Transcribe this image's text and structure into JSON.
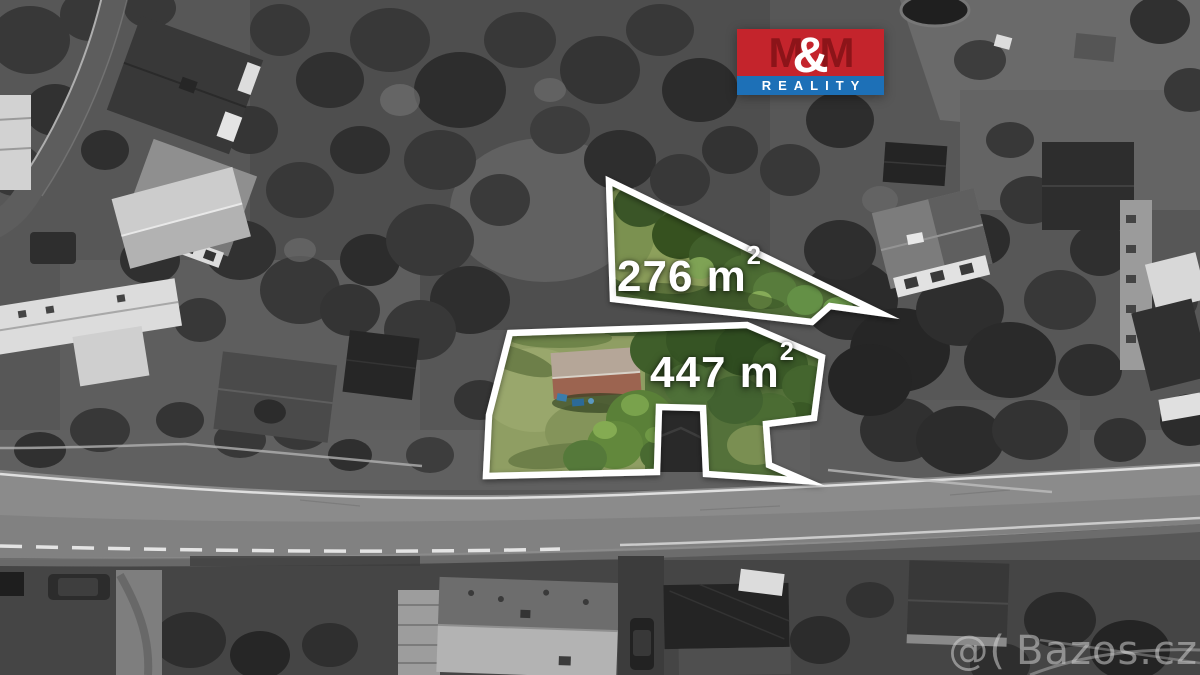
{
  "logo": {
    "m_left": "M",
    "ampersand": "&",
    "m_right": "M",
    "subtitle": "REALITY"
  },
  "plots": [
    {
      "name": "plot-276",
      "area_value": "276 m",
      "area_superscript": "2",
      "full_label": "276 m²"
    },
    {
      "name": "plot-447",
      "area_value": "447 m",
      "area_superscript": "2",
      "full_label": "447 m²"
    }
  ],
  "watermark": {
    "prefix": "@(",
    "text": "Bazos.cz"
  },
  "colors": {
    "outline": "#ffffff",
    "label_text": "#ffffff",
    "logo_red": "#c4242c",
    "logo_m_dark": "#8c1419",
    "logo_blue": "#1d70b7"
  }
}
